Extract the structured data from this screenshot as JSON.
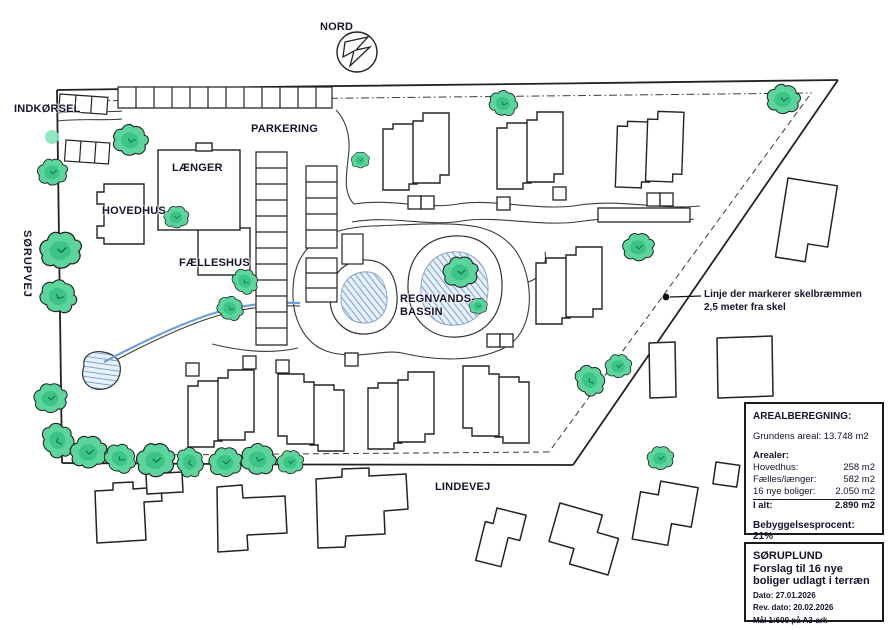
{
  "labels": {
    "north": "NORD",
    "entrance": "INDKØRSEL",
    "street_west": "SØRUPVEJ",
    "parking": "PARKERING",
    "laenger": "LÆNGER",
    "hovedhus": "HOVEDHUS",
    "faelleshus": "FÆLLESHUS",
    "basin_line1": "REGNVANDS-",
    "basin_line2": "BASSIN",
    "street_south": "LINDEVEJ"
  },
  "callout": {
    "line1": "Linje der markerer skelbræmmen",
    "line2": "2,5 meter fra skel"
  },
  "area_box": {
    "title": "AREALBEREGNING:",
    "ground_area": "Grundens areal: 13.748 m2",
    "areas_heading": "Arealer:",
    "rows": [
      {
        "label": "Hovedhus:",
        "value": "258 m2"
      },
      {
        "label": "Fælles/længer:",
        "value": "582 m2"
      },
      {
        "label": "16 nye boliger:",
        "value": "2.050 m2"
      },
      {
        "label": "I alt:",
        "value": "2.890 m2"
      }
    ],
    "coverage": "Bebyggelsesprocent: 21%"
  },
  "title_block": {
    "project": "SØRUPLUND",
    "subtitle_line1": "Forslag til 16 nye",
    "subtitle_line2": "boliger udlagt i terræn",
    "date": "Dato: 27.01.2026",
    "rev_date": "Rev. dato: 20.02.2026",
    "scale": "Mål 1:600 på A3-ark"
  },
  "colors": {
    "ink": "#2a2a2a",
    "label_ink": "#14142c",
    "tree_green": "#5cd49c",
    "tree_green_dark": "#2fbd7d",
    "water_line_blue": "#6f9fd8",
    "water_fill": "#e9f1fb"
  }
}
